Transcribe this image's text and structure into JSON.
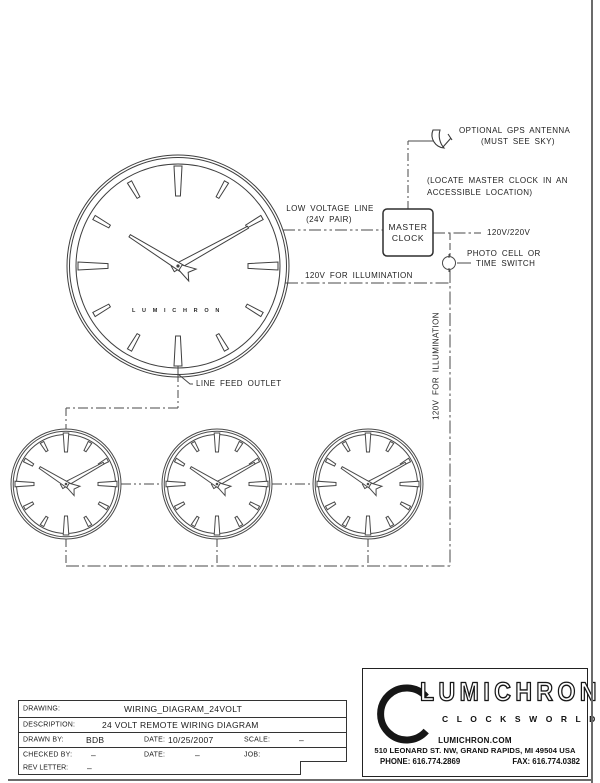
{
  "diagram": {
    "labels": {
      "gps_line1": "OPTIONAL GPS ANTENNA",
      "gps_line2": "(MUST SEE SKY)",
      "locate_line1": "(LOCATE MASTER CLOCK IN AN",
      "locate_line2": "ACCESSIBLE LOCATION)",
      "low_voltage_line1": "LOW VOLTAGE LINE",
      "low_voltage_line2": "(24V PAIR)",
      "master_clock_line1": "MASTER",
      "master_clock_line2": "CLOCK",
      "voltage": "120V/220V",
      "photo_cell_line1": "PHOTO CELL OR",
      "photo_cell_line2": "TIME SWITCH",
      "illumination_horizontal": "120V FOR ILLUMINATION",
      "illumination_vertical": "120V FOR ILLUMINATION",
      "line_feed_outlet": "LINE FEED OUTLET",
      "dial_brand": "L U M I C H R O N"
    },
    "clock_time_shown": "10:09",
    "line_color": "#4a4a4a"
  },
  "title_block": {
    "drawing_label": "DRAWING:",
    "drawing_value": "WIRING_DIAGRAM_24VOLT",
    "description_label": "DESCRIPTION:",
    "description_value": "24 VOLT REMOTE WIRING DIAGRAM",
    "drawn_by_label": "DRAWN BY:",
    "drawn_by_value": "BDB",
    "date1_label": "DATE:",
    "date1_value": "10/25/2007",
    "scale_label": "SCALE:",
    "scale_value": "–",
    "checked_by_label": "CHECKED BY:",
    "checked_by_value": "–",
    "date2_label": "DATE:",
    "date2_value": "–",
    "job_label": "JOB:",
    "rev_letter_label": "REV LETTER:",
    "rev_letter_value": "–"
  },
  "logo_block": {
    "brand": "LUMICHRON",
    "tagline": "C L O C K S   W O R L D W I D E",
    "website": "LUMICHRON.COM",
    "address": "510 LEONARD ST. NW, GRAND RAPIDS, MI 49504 USA",
    "phone": "PHONE: 616.774.2869",
    "fax": "FAX: 616.774.0382"
  }
}
